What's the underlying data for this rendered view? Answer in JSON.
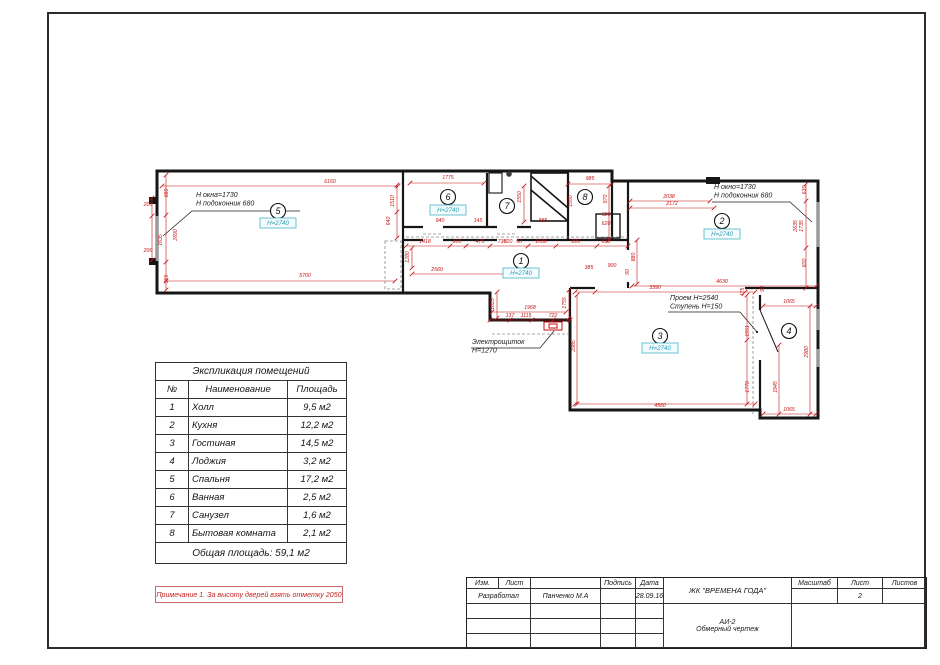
{
  "plan": {
    "colors": {
      "wall": "#161616",
      "dim": "#c41111",
      "badge_border": "#49b5c5",
      "badge_text": "#2f9fb4",
      "annotation": "#1c1c1c"
    },
    "rooms": [
      {
        "num": "1",
        "cx": 521,
        "cy": 261,
        "badge": "Н=2740",
        "bx": 521,
        "by": 270
      },
      {
        "num": "2",
        "cx": 722,
        "cy": 221,
        "badge": "Н=2740",
        "bx": 722,
        "by": 231
      },
      {
        "num": "3",
        "cx": 660,
        "cy": 336,
        "badge": "Н=2740",
        "bx": 660,
        "by": 345
      },
      {
        "num": "4",
        "cx": 789,
        "cy": 331
      },
      {
        "num": "5",
        "cx": 278,
        "cy": 211,
        "badge": "Н=2740",
        "bx": 278,
        "by": 220
      },
      {
        "num": "6",
        "cx": 448,
        "cy": 197,
        "badge": "Н=2740",
        "bx": 448,
        "by": 207
      },
      {
        "num": "7",
        "cx": 507,
        "cy": 206
      },
      {
        "num": "8",
        "cx": 585,
        "cy": 197
      }
    ],
    "annotations": [
      {
        "name": "window-left",
        "lines": [
          "Н окна=1730",
          "Н подоконник 680"
        ],
        "x": 196,
        "y": 197
      },
      {
        "name": "window-right",
        "lines": [
          "Н окно=1730",
          "Н подоконник 680"
        ],
        "x": 714,
        "y": 189
      },
      {
        "name": "opening",
        "lines": [
          "Проем Н=2540",
          "Ступень Н=150"
        ],
        "x": 670,
        "y": 300
      },
      {
        "name": "electro-panel",
        "lines": [
          "Электрощиток",
          "Н=1270"
        ],
        "x": 472,
        "y": 344
      }
    ],
    "dim_labels": [
      {
        "t": "6160",
        "x": 330,
        "y": 183,
        "r": 0
      },
      {
        "t": "680",
        "x": 168,
        "y": 193,
        "r": 90
      },
      {
        "t": "2690",
        "x": 177,
        "y": 235,
        "r": 90
      },
      {
        "t": "1635",
        "x": 162,
        "y": 240,
        "r": 90
      },
      {
        "t": "365",
        "x": 168,
        "y": 279,
        "r": 90
      },
      {
        "t": "200",
        "x": 148,
        "y": 206,
        "r": 0
      },
      {
        "t": "200",
        "x": 148,
        "y": 252,
        "r": 0
      },
      {
        "t": "5700",
        "x": 305,
        "y": 277,
        "r": 0
      },
      {
        "t": "1510",
        "x": 394,
        "y": 201,
        "r": 90
      },
      {
        "t": "640",
        "x": 390,
        "y": 221,
        "r": 90
      },
      {
        "t": "1775",
        "x": 448,
        "y": 179,
        "r": 0
      },
      {
        "t": "940",
        "x": 440,
        "y": 222,
        "r": 0
      },
      {
        "t": "145",
        "x": 478,
        "y": 222,
        "r": 0
      },
      {
        "t": "1550",
        "x": 521,
        "y": 197,
        "r": 90
      },
      {
        "t": "730",
        "x": 502,
        "y": 243,
        "r": 0
      },
      {
        "t": "50",
        "x": 519,
        "y": 243,
        "r": 0
      },
      {
        "t": "885",
        "x": 543,
        "y": 222,
        "r": 0
      },
      {
        "t": "985",
        "x": 590,
        "y": 180,
        "r": 0
      },
      {
        "t": "970",
        "x": 607,
        "y": 199,
        "r": 90
      },
      {
        "t": "1550",
        "x": 572,
        "y": 201,
        "r": 90
      },
      {
        "t": "520",
        "x": 606,
        "y": 216,
        "r": 0
      },
      {
        "t": "620",
        "x": 606,
        "y": 225,
        "r": 0
      },
      {
        "t": "1418",
        "x": 425,
        "y": 243,
        "r": 0
      },
      {
        "t": "800",
        "x": 457,
        "y": 243,
        "r": 0
      },
      {
        "t": "475",
        "x": 480,
        "y": 243,
        "r": 0
      },
      {
        "t": "820",
        "x": 508,
        "y": 243,
        "r": 0
      },
      {
        "t": "1030",
        "x": 541,
        "y": 243,
        "r": 0
      },
      {
        "t": "810",
        "x": 576,
        "y": 243,
        "r": 0
      },
      {
        "t": "610",
        "x": 606,
        "y": 243,
        "r": 0
      },
      {
        "t": "1280",
        "x": 409,
        "y": 257,
        "r": 90
      },
      {
        "t": "2560",
        "x": 437,
        "y": 271,
        "r": 0
      },
      {
        "t": "1968",
        "x": 530,
        "y": 309,
        "r": 0
      },
      {
        "t": "137",
        "x": 510,
        "y": 317,
        "r": 0
      },
      {
        "t": "1115",
        "x": 526,
        "y": 317,
        "r": 0
      },
      {
        "t": "722",
        "x": 553,
        "y": 317,
        "r": 0
      },
      {
        "t": "1755",
        "x": 566,
        "y": 303,
        "r": 90
      },
      {
        "t": "1025",
        "x": 494,
        "y": 304,
        "r": 90
      },
      {
        "t": "385",
        "x": 589,
        "y": 269,
        "r": 0
      },
      {
        "t": "900",
        "x": 612,
        "y": 267,
        "r": 0
      },
      {
        "t": "90",
        "x": 629,
        "y": 272,
        "r": 90
      },
      {
        "t": "2038",
        "x": 669,
        "y": 198,
        "r": 0
      },
      {
        "t": "2172",
        "x": 672,
        "y": 205,
        "r": 0
      },
      {
        "t": "4630",
        "x": 722,
        "y": 283,
        "r": 0
      },
      {
        "t": "630",
        "x": 806,
        "y": 190,
        "r": 90
      },
      {
        "t": "2635",
        "x": 797,
        "y": 226,
        "r": 90
      },
      {
        "t": "1735",
        "x": 803,
        "y": 226,
        "r": 90
      },
      {
        "t": "600",
        "x": 806,
        "y": 263,
        "r": 90
      },
      {
        "t": "880",
        "x": 635,
        "y": 257,
        "r": 90
      },
      {
        "t": "3390",
        "x": 655,
        "y": 289,
        "r": 0
      },
      {
        "t": "475",
        "x": 744,
        "y": 292,
        "r": 90
      },
      {
        "t": "2985",
        "x": 575,
        "y": 346,
        "r": 90
      },
      {
        "t": "4560",
        "x": 660,
        "y": 407,
        "r": 0
      },
      {
        "t": "1551",
        "x": 749,
        "y": 331,
        "r": 90
      },
      {
        "t": "1770",
        "x": 749,
        "y": 387,
        "r": 90
      },
      {
        "t": "1065",
        "x": 789,
        "y": 303,
        "r": 0
      },
      {
        "t": "1065",
        "x": 789,
        "y": 411,
        "r": 0
      },
      {
        "t": "2980",
        "x": 808,
        "y": 352,
        "r": 90
      },
      {
        "t": "1945",
        "x": 777,
        "y": 387,
        "r": 90
      },
      {
        "t": "90",
        "x": 764,
        "y": 289,
        "r": 90
      }
    ]
  },
  "explication": {
    "title": "Экспликация помещений",
    "headers": {
      "num": "№",
      "name": "Наименование",
      "area": "Площадь"
    },
    "rows": [
      {
        "num": "1",
        "name": "Холл",
        "area": "9,5 м2"
      },
      {
        "num": "2",
        "name": "Кухня",
        "area": "12,2 м2"
      },
      {
        "num": "3",
        "name": "Гостиная",
        "area": "14,5 м2"
      },
      {
        "num": "4",
        "name": "Лоджия",
        "area": "3,2 м2"
      },
      {
        "num": "5",
        "name": "Спальня",
        "area": "17,2 м2"
      },
      {
        "num": "6",
        "name": "Ванная",
        "area": "2,5 м2"
      },
      {
        "num": "7",
        "name": "Санузел",
        "area": "1,6 м2"
      },
      {
        "num": "8",
        "name": "Бытовая комната",
        "area": "2,1 м2"
      }
    ],
    "total": "Общая площадь: 59,1 м2"
  },
  "note": "Примечание 1. За высоту дверей взять отметку 2050",
  "titleblock": {
    "labels": {
      "izm": "Изм.",
      "sheet": "Лист",
      "signature": "Подпись",
      "date": "Дата",
      "developed": "Разработал",
      "scale": "Масштаб",
      "sheet2": "Лист",
      "sheets": "Листов"
    },
    "values": {
      "author": "Панченко М.А",
      "date": "28.09.16",
      "project": "ЖК \"ВРЕМЕНА ГОДА\"",
      "code": "АИ-2",
      "doc_name": "Обмерный чертеж",
      "sheet_num": "2"
    }
  }
}
